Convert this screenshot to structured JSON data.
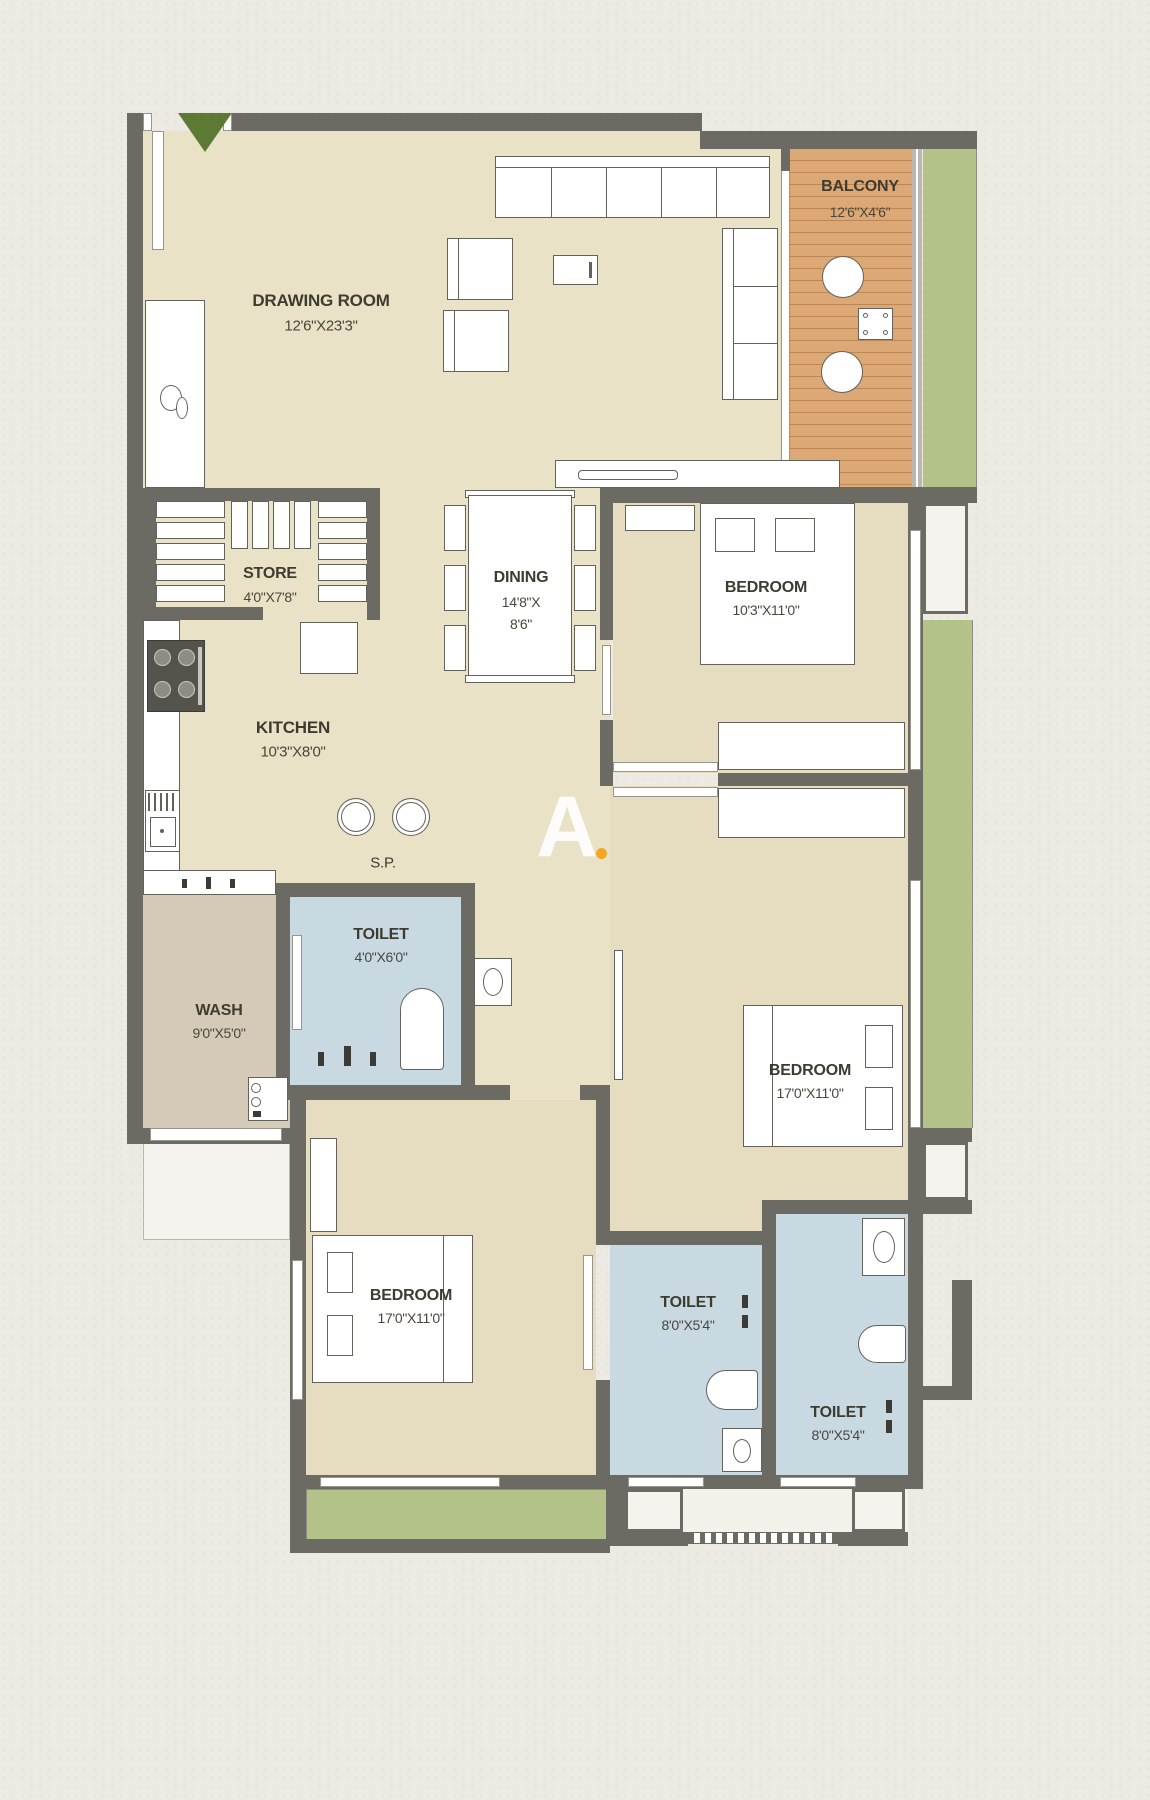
{
  "meta": {
    "type": "apartment-floor-plan",
    "watermark_letter": "A"
  },
  "colors": {
    "bg": "#eceae2",
    "wall": "#6b6a63",
    "floor": "#e9e2c7",
    "floor2": "#e6ddc0",
    "toilet": "#c8d9e2",
    "wash": "#d4cab7",
    "wood": "#dca876",
    "green": "#b2c289",
    "text": "#3e3c31",
    "accent": "#f5a623",
    "entry_arrow": "#5d7a35"
  },
  "rooms": {
    "drawing_room": {
      "name": "DRAWING ROOM",
      "dims": "12'6\"X23'3\""
    },
    "balcony": {
      "name": "BALCONY",
      "dims": "12'6\"X4'6\""
    },
    "store": {
      "name": "STORE",
      "dims": "4'0\"X7'8\""
    },
    "dining": {
      "name": "DINING",
      "dims_line1": "14'8\"X",
      "dims_line2": "8'6\""
    },
    "bedroom_top": {
      "name": "BEDROOM",
      "dims": "10'3\"X11'0\""
    },
    "kitchen": {
      "name": "KITCHEN",
      "dims": "10'3\"X8'0\""
    },
    "sp": {
      "name": "S.P."
    },
    "toilet_mid": {
      "name": "TOILET",
      "dims": "4'0\"X6'0\""
    },
    "wash": {
      "name": "WASH",
      "dims": "9'0\"X5'0\""
    },
    "bedroom_mid": {
      "name": "BEDROOM",
      "dims": "17'0\"X11'0\""
    },
    "bedroom_bot": {
      "name": "BEDROOM",
      "dims": "17'0\"X11'0\""
    },
    "toilet_bm": {
      "name": "TOILET",
      "dims": "8'0\"X5'4\""
    },
    "toilet_br": {
      "name": "TOILET",
      "dims": "8'0\"X5'4\""
    }
  }
}
